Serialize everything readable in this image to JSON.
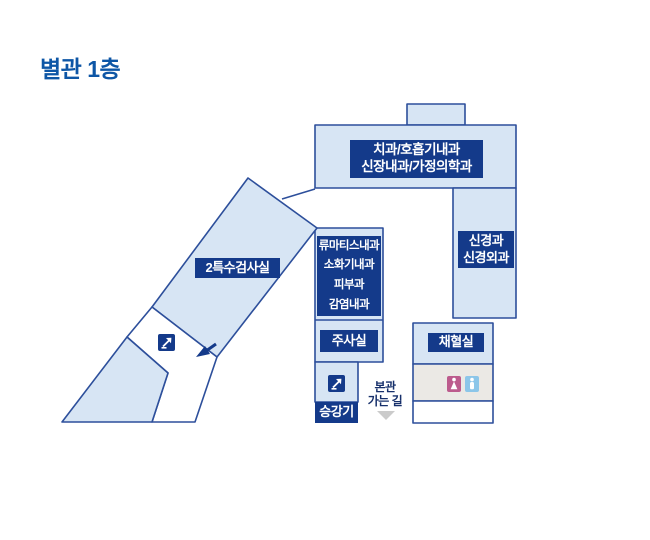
{
  "page": {
    "title": "별관 1층"
  },
  "rooms": {
    "top_building": {
      "line1": "치과/호흡기내과",
      "line2": "신장내과/가정의학과"
    },
    "right_wing": {
      "line1": "신경과",
      "line2": "신경외과"
    },
    "special_lab": {
      "label": "2특수검사실"
    },
    "clinics": {
      "line1": "류마티스내과",
      "line2": "소화기내과",
      "line3": "피부과",
      "line4": "감염내과"
    },
    "injection_room": {
      "label": "주사실"
    },
    "blood_room": {
      "label": "채혈실"
    },
    "elevator": {
      "label": "승강기"
    }
  },
  "annotations": {
    "main_path_line1": "본관",
    "main_path_line2": "가는 길"
  },
  "icons": {
    "escalator_corridor": "escalator-icon",
    "escalator_lobby": "escalator-icon",
    "restroom_female": "female-restroom-icon",
    "restroom_male": "male-restroom-icon",
    "band_direction": "down-left-arrow-icon",
    "main_path_direction": "down-chevron-icon"
  },
  "colors": {
    "room_fill": "#d7e5f4",
    "outline": "#2d4f9b",
    "label_box": "#143a8a",
    "title_text": "#0d56a6",
    "path_text": "#17306b",
    "restroom_area_fill": "#ebe9e5",
    "female_icon": "#bc5b8d",
    "male_icon": "#8cc6e9",
    "chevron": "#cbcbcb"
  }
}
